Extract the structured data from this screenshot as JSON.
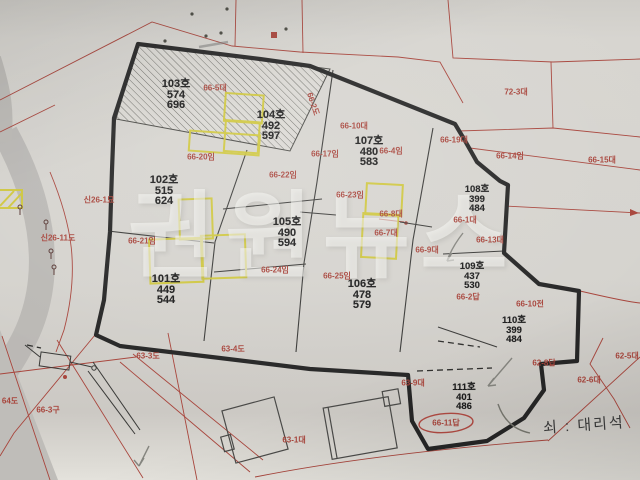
{
  "watermark": {
    "text": "권원뉴스"
  },
  "annotation": {
    "note": "쇠 : 대리석"
  },
  "parcels": [
    {
      "id": "101",
      "name": "101호",
      "v1": "449",
      "v2": "544"
    },
    {
      "id": "102",
      "name": "102호",
      "v1": "515",
      "v2": "624"
    },
    {
      "id": "103",
      "name": "103호",
      "v1": "574",
      "v2": "696"
    },
    {
      "id": "104",
      "name": "104호",
      "v1": "492",
      "v2": "597"
    },
    {
      "id": "105",
      "name": "105호",
      "v1": "490",
      "v2": "594"
    },
    {
      "id": "106",
      "name": "106호",
      "v1": "478",
      "v2": "579"
    },
    {
      "id": "107",
      "name": "107호",
      "v1": "480",
      "v2": "583"
    },
    {
      "id": "108",
      "name": "108호",
      "v1": "399",
      "v2": "484"
    },
    {
      "id": "109",
      "name": "109호",
      "v1": "437",
      "v2": "530"
    },
    {
      "id": "110",
      "name": "110호",
      "v1": "399",
      "v2": "484"
    },
    {
      "id": "111",
      "name": "111호",
      "v1": "401",
      "v2": "486"
    }
  ],
  "lot_labels": [
    {
      "text": "66-5대"
    },
    {
      "text": "66-2도"
    },
    {
      "text": "66-10대"
    },
    {
      "text": "66-4임"
    },
    {
      "text": "66-19대"
    },
    {
      "text": "72-3대"
    },
    {
      "text": "66-14임"
    },
    {
      "text": "66-15대"
    },
    {
      "text": "66-17임"
    },
    {
      "text": "66-20임"
    },
    {
      "text": "66-22임"
    },
    {
      "text": "66-23임"
    },
    {
      "text": "66-21임"
    },
    {
      "text": "66-24임"
    },
    {
      "text": "66-25임"
    },
    {
      "text": "66-8대"
    },
    {
      "text": "66-7대"
    },
    {
      "text": "66-9대"
    },
    {
      "text": "66-1대"
    },
    {
      "text": "66-13대"
    },
    {
      "text": "66-2답"
    },
    {
      "text": "66-10전"
    },
    {
      "text": "62-8답"
    },
    {
      "text": "62-5대"
    },
    {
      "text": "62-6대"
    },
    {
      "text": "63-9대"
    },
    {
      "text": "63-3도"
    },
    {
      "text": "63-4도"
    },
    {
      "text": "64도"
    },
    {
      "text": "66-3구"
    },
    {
      "text": "63-1대"
    },
    {
      "text": "신26-1묘"
    },
    {
      "text": "신26-11도"
    },
    {
      "text": "66-11답"
    }
  ],
  "colors": {
    "paper": "#d5d3ce",
    "red_line": "#a8453c",
    "boundary_black": "#262626",
    "building_yellow": "#cfc73a",
    "gray_road": "#b8b6b2",
    "watermark_white": "rgba(252,252,248,0.52)"
  }
}
